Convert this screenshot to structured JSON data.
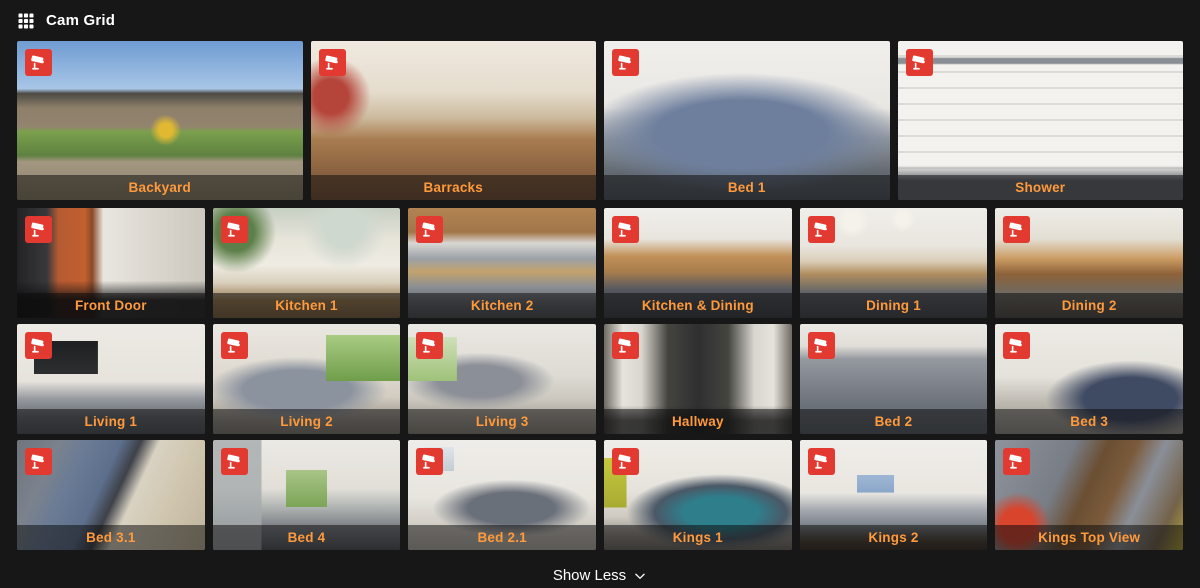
{
  "header": {
    "title": "Cam Grid"
  },
  "colors": {
    "background": "#171717",
    "label_orange": "#ff9a3c",
    "badge_red": "#e23a30"
  },
  "grid": {
    "rows": [
      {
        "size": "large",
        "tiles": [
          {
            "label": "Backyard",
            "scene": "backyard"
          },
          {
            "label": "Barracks",
            "scene": "barracks"
          },
          {
            "label": "Bed 1",
            "scene": "bed1"
          },
          {
            "label": "Shower",
            "scene": "shower"
          }
        ]
      },
      {
        "size": "small",
        "tiles": [
          {
            "label": "Front Door",
            "scene": "frontdoor"
          },
          {
            "label": "Kitchen 1",
            "scene": "kitchen1"
          },
          {
            "label": "Kitchen 2",
            "scene": "kitchen2"
          },
          {
            "label": "Kitchen & Dining",
            "scene": "kitchendining"
          },
          {
            "label": "Dining 1",
            "scene": "dining1"
          },
          {
            "label": "Dining 2",
            "scene": "dining2"
          }
        ]
      },
      {
        "size": "small",
        "tiles": [
          {
            "label": "Living 1",
            "scene": "living1"
          },
          {
            "label": "Living 2",
            "scene": "living2"
          },
          {
            "label": "Living 3",
            "scene": "living3"
          },
          {
            "label": "Hallway",
            "scene": "hallway"
          },
          {
            "label": "Bed 2",
            "scene": "bed2"
          },
          {
            "label": "Bed 3",
            "scene": "bed3"
          }
        ]
      },
      {
        "size": "small",
        "tiles": [
          {
            "label": "Bed 3.1",
            "scene": "bed31"
          },
          {
            "label": "Bed 4",
            "scene": "bed4"
          },
          {
            "label": "Bed 2.1",
            "scene": "bed21"
          },
          {
            "label": "Kings 1",
            "scene": "kings1"
          },
          {
            "label": "Kings 2",
            "scene": "kings2"
          },
          {
            "label": "Kings Top View",
            "scene": "kingstop"
          }
        ]
      }
    ]
  },
  "footer": {
    "show_less_label": "Show Less"
  }
}
